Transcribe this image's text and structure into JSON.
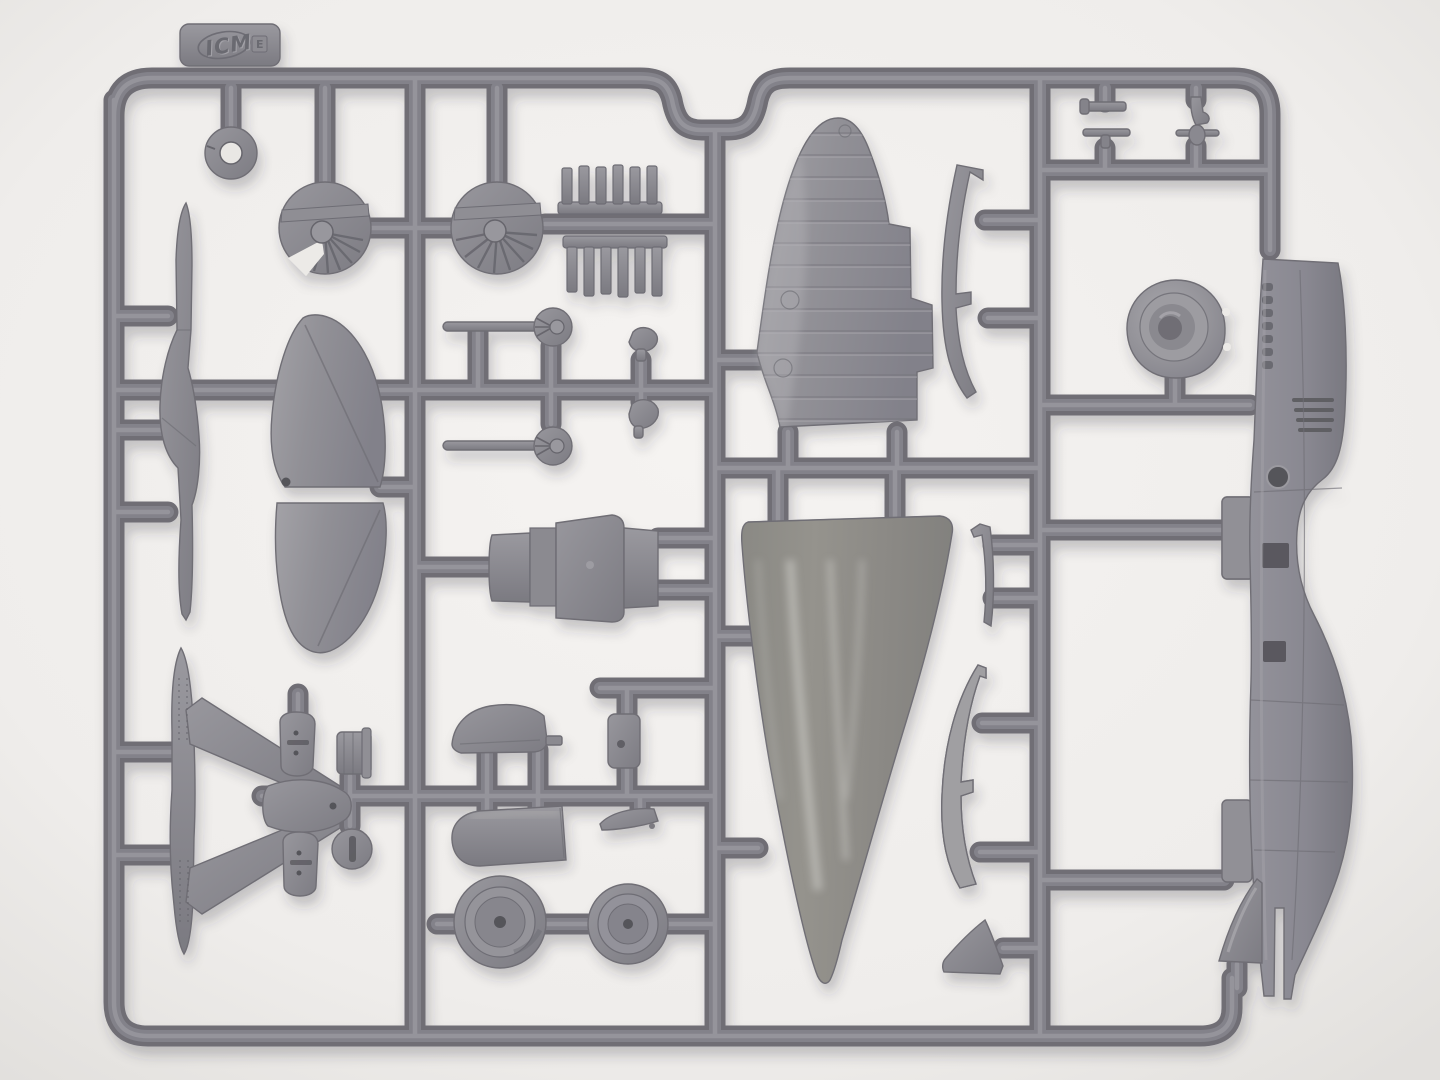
{
  "image": {
    "type": "photograph",
    "subject": "Top-down photograph of a gray injection-molded plastic model aircraft sprue (parts tree) on a white surface"
  },
  "colors": {
    "background": "#f2f0ee",
    "background_edge": "#e4e2df",
    "plastic_base": "#83828a",
    "plastic_dark": "#6f6e75",
    "plastic_light": "#95949b",
    "plastic_sheen": "#cfcec9",
    "detail_dark": "#55545a",
    "shadow": "#34343a"
  },
  "sprue": {
    "brand_logo_text": "ICM",
    "mold_stamp": "E",
    "frame_shape": "rounded rectangle runner frame with a recessed notch at top center",
    "parts": [
      {
        "name": "brand-tab",
        "location": "top-left",
        "description": "molded tab with embossed ICM oval logo and stamp"
      },
      {
        "name": "ring-grommet",
        "location": "top-left"
      },
      {
        "name": "radial-engine-face-left",
        "location": "top-left"
      },
      {
        "name": "radial-engine-face-right",
        "location": "top-center-left"
      },
      {
        "name": "exhaust-stub-strip-upper",
        "location": "top-center"
      },
      {
        "name": "exhaust-stub-strip-lower",
        "location": "top-center"
      },
      {
        "name": "float-keel-blade",
        "location": "left-edge"
      },
      {
        "name": "elevator-half-upper",
        "location": "left-center"
      },
      {
        "name": "elevator-half-lower",
        "location": "left-center"
      },
      {
        "name": "axle-pin-with-disc-upper",
        "location": "center"
      },
      {
        "name": "axle-pin-with-disc-lower",
        "location": "center"
      },
      {
        "name": "control-horn-upper",
        "location": "center"
      },
      {
        "name": "control-horn-lower",
        "location": "center"
      },
      {
        "name": "stepped-spine-block",
        "location": "center"
      },
      {
        "name": "wing-panel-ribbed",
        "location": "upper-center"
      },
      {
        "name": "root-rib-strip-upper",
        "location": "upper-center-right"
      },
      {
        "name": "wing-panel-glossy",
        "location": "lower-center"
      },
      {
        "name": "narrow-strip",
        "location": "center-right"
      },
      {
        "name": "root-rib-strip-lower",
        "location": "center-right"
      },
      {
        "name": "wingtip-triangle",
        "location": "lower-center-right"
      },
      {
        "name": "cruciform-tail-unit",
        "location": "bottom-left"
      },
      {
        "name": "seat-upper",
        "location": "bottom-left"
      },
      {
        "name": "seat-lower",
        "location": "bottom-left"
      },
      {
        "name": "drum-part",
        "location": "bottom-left"
      },
      {
        "name": "hub-disc",
        "location": "bottom-left"
      },
      {
        "name": "headrest-fairing",
        "location": "bottom-center"
      },
      {
        "name": "engine-cowling",
        "location": "bottom-center"
      },
      {
        "name": "equipment-box",
        "location": "bottom-center"
      },
      {
        "name": "chine-wedge",
        "location": "bottom-center"
      },
      {
        "name": "main-wheel-large",
        "location": "bottom-center"
      },
      {
        "name": "main-wheel-small",
        "location": "bottom-center"
      },
      {
        "name": "cowl-front-disc",
        "location": "right"
      },
      {
        "name": "fuselage-half",
        "location": "right-edge",
        "description": "long fuselage half with louvers, port row, round window and forked tail"
      },
      {
        "name": "tailfin-fillet",
        "location": "bottom-right"
      },
      {
        "name": "small-fitting-1",
        "location": "top-right"
      },
      {
        "name": "small-fitting-2",
        "location": "top-right"
      },
      {
        "name": "small-fitting-3",
        "location": "top-right"
      },
      {
        "name": "small-fitting-4",
        "location": "top-right"
      }
    ]
  }
}
